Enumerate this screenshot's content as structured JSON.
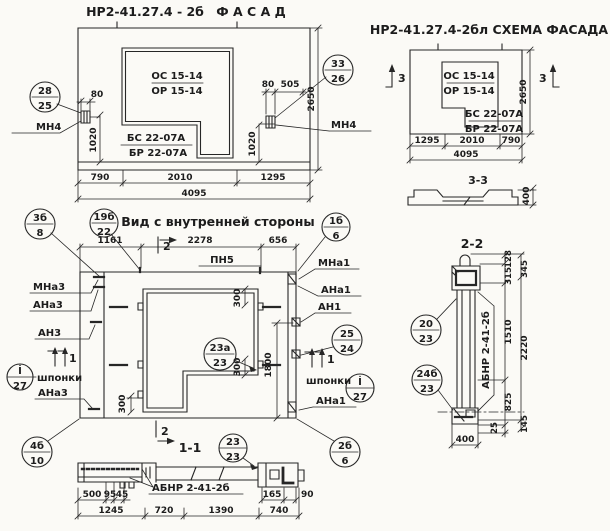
{
  "facade": {
    "code": "НР2-41.27.4 - 2б",
    "title": "Ф А С А Д",
    "oc": "ОС 15-14",
    "orr": "ОР 15-14",
    "bs": "БС 22-07А",
    "br": "БР 22-07А",
    "cl_n": "28",
    "cl_d": "25",
    "cr_n": "33",
    "cr_d": "26",
    "mn4_left": "МН4",
    "mn4_right": "МН4",
    "d80_left": "80",
    "d1020_left": "1020",
    "d80_right": "80",
    "d505": "505",
    "d1020_right": "1020",
    "d2650": "2650",
    "d790": "790",
    "d2010": "2010",
    "d1295": "1295",
    "d4095": "4095"
  },
  "schema": {
    "title": "НР2-41.27.4-2бл СХЕМА ФАСАДА",
    "oc": "ОС 15-14",
    "orr": "ОР 15-14",
    "bs": "БС 22-07А",
    "br": "БР 22-07А",
    "mark_left": "3",
    "mark_right": "3",
    "d2650": "2650",
    "d1295": "1295",
    "d2010": "2010",
    "d790": "790",
    "d4095": "4095",
    "profile_title": "3-3",
    "d400": "400"
  },
  "inner": {
    "title": "Вид с внутренней стороны",
    "pn5": "ПН5",
    "mna3": "МНа3",
    "ana3": "АНа3",
    "an3": "АН3",
    "shponki_left": "шпонки",
    "ana3_low": "АНа3",
    "mna1": "МНа1",
    "ana1": "АНа1",
    "an1": "АН1",
    "shponki_right": "шпонки",
    "ana1_low": "АНа1",
    "d1161": "1161",
    "d2278": "2278",
    "d656": "656",
    "d300a": "300",
    "d300b": "300",
    "d300c": "300",
    "d1800": "1800",
    "mark2_top": "2",
    "mark2_bottom": "2",
    "mark1_left": "1",
    "mark1_right": "1",
    "c3b_n": "3б",
    "c3b_d": "8",
    "c19b_n": "19б",
    "c19b_d": "22",
    "c1b_n": "1б",
    "c1b_d": "6",
    "c23a_n": "23а",
    "c23a_d": "23",
    "c25_n": "25",
    "c25_d": "24",
    "ci_left_n": "İ",
    "ci_left_d": "27",
    "ci_right_n": "İ",
    "ci_right_d": "27",
    "c4b_n": "4б",
    "c4b_d": "10",
    "c2b_n": "2б",
    "c2b_d": "6"
  },
  "s11": {
    "title": "1-1",
    "label": "АБНР 2-41-2б",
    "c_n": "23",
    "c_d": "23",
    "d500": "500",
    "d95": "95",
    "d45": "45",
    "d1245": "1245",
    "d720": "720",
    "d1390": "1390",
    "d740": "740",
    "d165": "165",
    "d90": "90"
  },
  "s22": {
    "title": "2-2",
    "label": "АБНР 2-41-2б",
    "c20_n": "20",
    "c20_d": "23",
    "c24_n": "24б",
    "c24_d": "23",
    "d128": "128",
    "d315": "315",
    "d345": "345",
    "d1510": "1510",
    "d2220": "2220",
    "d825": "825",
    "d25": "25",
    "d145": "145",
    "d400": "400"
  }
}
